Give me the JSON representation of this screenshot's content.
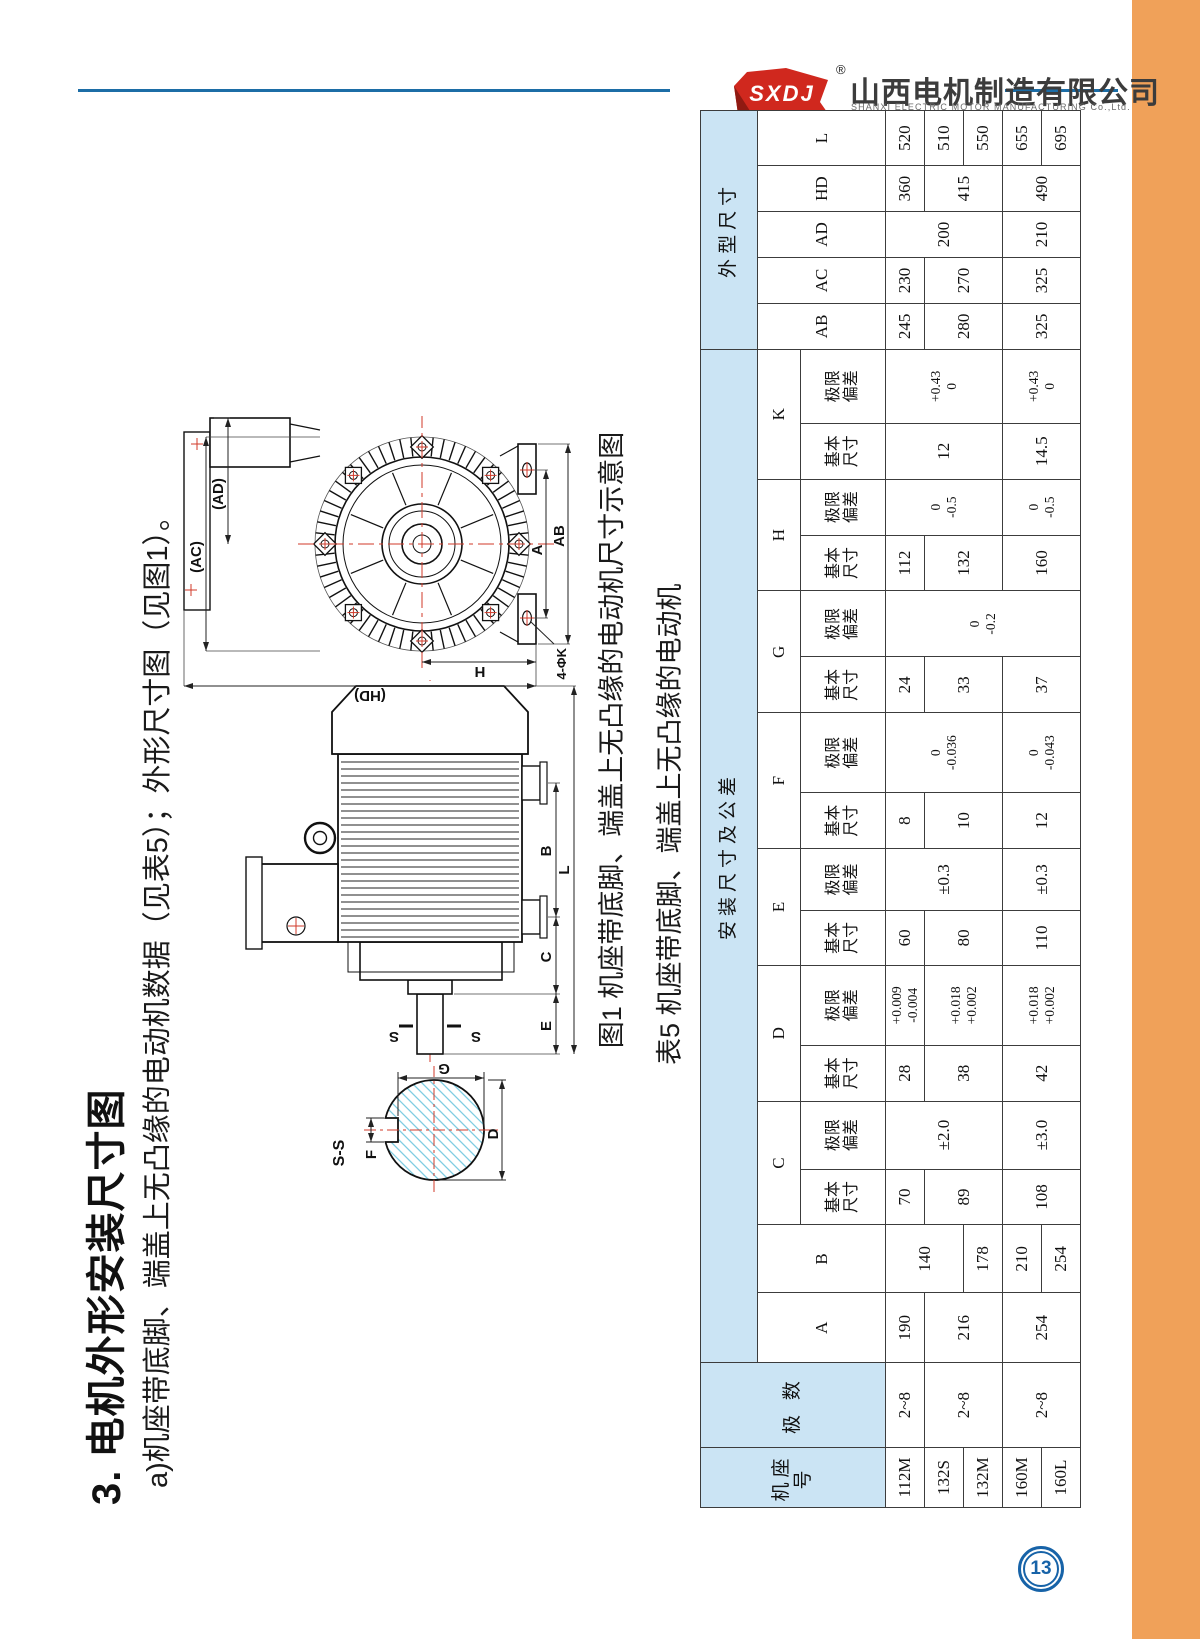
{
  "header": {
    "logo_text": "SXDJ",
    "registered_mark": "®",
    "company_cn": "山西电机制造有限公司",
    "company_en": "SHANXI ELECTRIC MOTOR MANUFACTURING Co.,Ltd."
  },
  "section": {
    "title": "3. 电机外形安装尺寸图",
    "subtitle": "a)机座带底脚、端盖上无凸缘的电动机数据（见表5）；外形尺寸图（见图1）。"
  },
  "figure": {
    "caption": "图1 机座带底脚、端盖上无凸缘的电动机尺寸示意图",
    "end_view": {
      "ac": "(AC)",
      "ad": "(AD)",
      "a": "A",
      "ab": "AB",
      "h": "H",
      "hd": "(HD)",
      "k_callout": "4-ΦK"
    },
    "side_view": {
      "s1": "S",
      "s2": "S",
      "e": "E",
      "c": "C",
      "b": "B",
      "l": "L"
    },
    "section_view": {
      "title": "S-S",
      "f": "F",
      "g": "G",
      "d": "D"
    }
  },
  "table": {
    "caption": "表5 机座带底脚、端盖上无凸缘的电动机",
    "header_rows": [
      [
        {
          "t": "机座号",
          "rs": 3,
          "c": "hd"
        },
        {
          "t": "极 数",
          "rs": 3,
          "c": "hd"
        },
        {
          "t": "安装尺寸及公差",
          "cs": 16,
          "c": "hd"
        },
        {
          "t": "外型尺寸",
          "cs": 5,
          "c": "hd"
        }
      ],
      [
        {
          "t": "A",
          "rs": 2,
          "c": "sub"
        },
        {
          "t": "B",
          "rs": 2,
          "c": "sub"
        },
        {
          "t": "C",
          "cs": 2,
          "c": "sub"
        },
        {
          "t": "D",
          "cs": 2,
          "c": "sub"
        },
        {
          "t": "E",
          "cs": 2,
          "c": "sub"
        },
        {
          "t": "F",
          "cs": 2,
          "c": "sub"
        },
        {
          "t": "G",
          "cs": 2,
          "c": "sub"
        },
        {
          "t": "H",
          "cs": 2,
          "c": "sub"
        },
        {
          "t": "K",
          "cs": 2,
          "c": "sub"
        },
        {
          "t": "AB",
          "rs": 2,
          "c": "sub"
        },
        {
          "t": "AC",
          "rs": 2,
          "c": "sub"
        },
        {
          "t": "AD",
          "rs": 2,
          "c": "sub"
        },
        {
          "t": "HD",
          "rs": 2,
          "c": "sub"
        },
        {
          "t": "L",
          "rs": 2,
          "c": "sub"
        }
      ],
      [
        {
          "t": "基本\n尺寸",
          "c": "sub2"
        },
        {
          "t": "极限\n偏差",
          "c": "sub2"
        },
        {
          "t": "基本\n尺寸",
          "c": "sub2"
        },
        {
          "t": "极限\n偏差",
          "c": "sub2"
        },
        {
          "t": "基本\n尺寸",
          "c": "sub2"
        },
        {
          "t": "极限\n偏差",
          "c": "sub2"
        },
        {
          "t": "基本\n尺寸",
          "c": "sub2"
        },
        {
          "t": "极限\n偏差",
          "c": "sub2"
        },
        {
          "t": "基本\n尺寸",
          "c": "sub2"
        },
        {
          "t": "极限\n偏差",
          "c": "sub2"
        },
        {
          "t": "基本\n尺寸",
          "c": "sub2"
        },
        {
          "t": "极限\n偏差",
          "c": "sub2"
        },
        {
          "t": "基本\n尺寸",
          "c": "sub2"
        },
        {
          "t": "极限\n偏差",
          "c": "sub2"
        }
      ]
    ],
    "body_rows": [
      [
        {
          "t": "112M"
        },
        {
          "t": "2~8"
        },
        {
          "t": "190"
        },
        {
          "t": "140",
          "rs": 2
        },
        {
          "t": "70"
        },
        {
          "t": "±2.0",
          "rs": 3
        },
        {
          "t": "28"
        },
        {
          "t": "+0.009\n-0.004",
          "c": "tol"
        },
        {
          "t": "60"
        },
        {
          "t": "±0.3",
          "rs": 3
        },
        {
          "t": "8"
        },
        {
          "t": "0\n-0.036",
          "rs": 3,
          "c": "tol"
        },
        {
          "t": "24"
        },
        {
          "t": "0\n-0.2",
          "rs": 5,
          "c": "tol"
        },
        {
          "t": "112"
        },
        {
          "t": "0\n-0.5",
          "rs": 3,
          "c": "tol"
        },
        {
          "t": "12",
          "rs": 3
        },
        {
          "t": "+0.43\n0",
          "rs": 3,
          "c": "tol"
        },
        {
          "t": "245"
        },
        {
          "t": "230"
        },
        {
          "t": "200",
          "rs": 3
        },
        {
          "t": "360"
        },
        {
          "t": "520"
        }
      ],
      [
        {
          "t": "132S"
        },
        {
          "t": "2~8",
          "rs": 2
        },
        {
          "t": "216",
          "rs": 2
        },
        {
          "t": "89",
          "rs": 2
        },
        {
          "t": "38",
          "rs": 2
        },
        {
          "t": "+0.018\n+0.002",
          "rs": 2,
          "c": "tol"
        },
        {
          "t": "80",
          "rs": 2
        },
        {
          "t": "10",
          "rs": 2
        },
        {
          "t": "33",
          "rs": 2
        },
        {
          "t": "132",
          "rs": 2
        },
        {
          "t": "280",
          "rs": 2
        },
        {
          "t": "270",
          "rs": 2
        },
        {
          "t": "415",
          "rs": 2
        },
        {
          "t": "510"
        }
      ],
      [
        {
          "t": "132M"
        },
        {
          "t": "178"
        },
        {
          "t": "550"
        }
      ],
      [
        {
          "t": "160M"
        },
        {
          "t": "2~8",
          "rs": 2
        },
        {
          "t": "254",
          "rs": 2
        },
        {
          "t": "210"
        },
        {
          "t": "108",
          "rs": 2
        },
        {
          "t": "±3.0",
          "rs": 2
        },
        {
          "t": "42",
          "rs": 2
        },
        {
          "t": "+0.018\n+0.002",
          "rs": 2,
          "c": "tol"
        },
        {
          "t": "110",
          "rs": 2
        },
        {
          "t": "±0.3",
          "rs": 2
        },
        {
          "t": "12",
          "rs": 2
        },
        {
          "t": "0\n-0.043",
          "rs": 2,
          "c": "tol"
        },
        {
          "t": "37",
          "rs": 2
        },
        {
          "t": "160",
          "rs": 2
        },
        {
          "t": "0\n-0.5",
          "rs": 2,
          "c": "tol"
        },
        {
          "t": "14.5",
          "rs": 2
        },
        {
          "t": "+0.43\n0",
          "rs": 2,
          "c": "tol"
        },
        {
          "t": "325",
          "rs": 2
        },
        {
          "t": "325",
          "rs": 2
        },
        {
          "t": "210",
          "rs": 2
        },
        {
          "t": "490",
          "rs": 2
        },
        {
          "t": "655"
        }
      ],
      [
        {
          "t": "160L"
        },
        {
          "t": "254"
        },
        {
          "t": "695"
        }
      ]
    ]
  },
  "page_number": "13",
  "colors": {
    "accent_orange": "#f0a159",
    "rule_blue": "#1c6da6",
    "logo_red": "#d0281e",
    "table_header_blue": "#cbe4f4",
    "page_number_blue": "#1763a8"
  }
}
